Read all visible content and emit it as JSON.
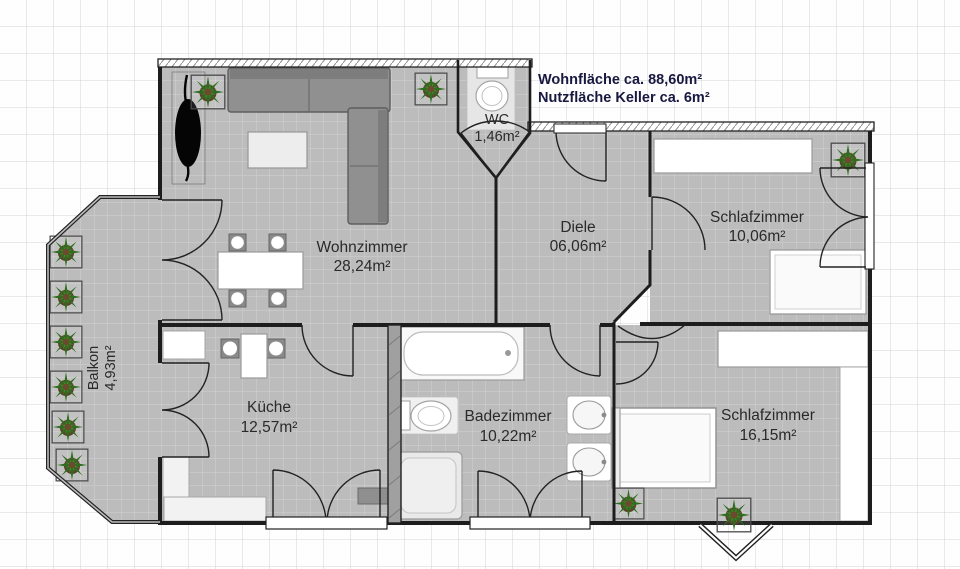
{
  "title_block": {
    "line1": "Wohnfläche ca. 88,60m²",
    "line2": "Nutzfläche Keller ca. 6m²"
  },
  "rooms": [
    {
      "id": "wohnzimmer",
      "name": "Wohnzimmer",
      "area": "28,24m²"
    },
    {
      "id": "diele",
      "name": "Diele",
      "area": "06,06m²"
    },
    {
      "id": "schlafzimmer-1",
      "name": "Schlafzimmer",
      "area": "10,06m²"
    },
    {
      "id": "wc",
      "name": "WC",
      "area": "1,46m²"
    },
    {
      "id": "kueche",
      "name": "Küche",
      "area": "12,57m²"
    },
    {
      "id": "badezimmer",
      "name": "Badezimmer",
      "area": "10,22m²"
    },
    {
      "id": "schlafzimmer-2",
      "name": "Schlafzimmer",
      "area": "16,15m²"
    },
    {
      "id": "balkon",
      "name": "Balkon",
      "area": "4,93m²"
    }
  ],
  "colors": {
    "floor_gray": "#bcbcbc",
    "wall_black": "#1d1d1d",
    "title_text_navy": "#181840",
    "plant_green": "#2f6d1f",
    "furniture_gray": "#909090"
  }
}
